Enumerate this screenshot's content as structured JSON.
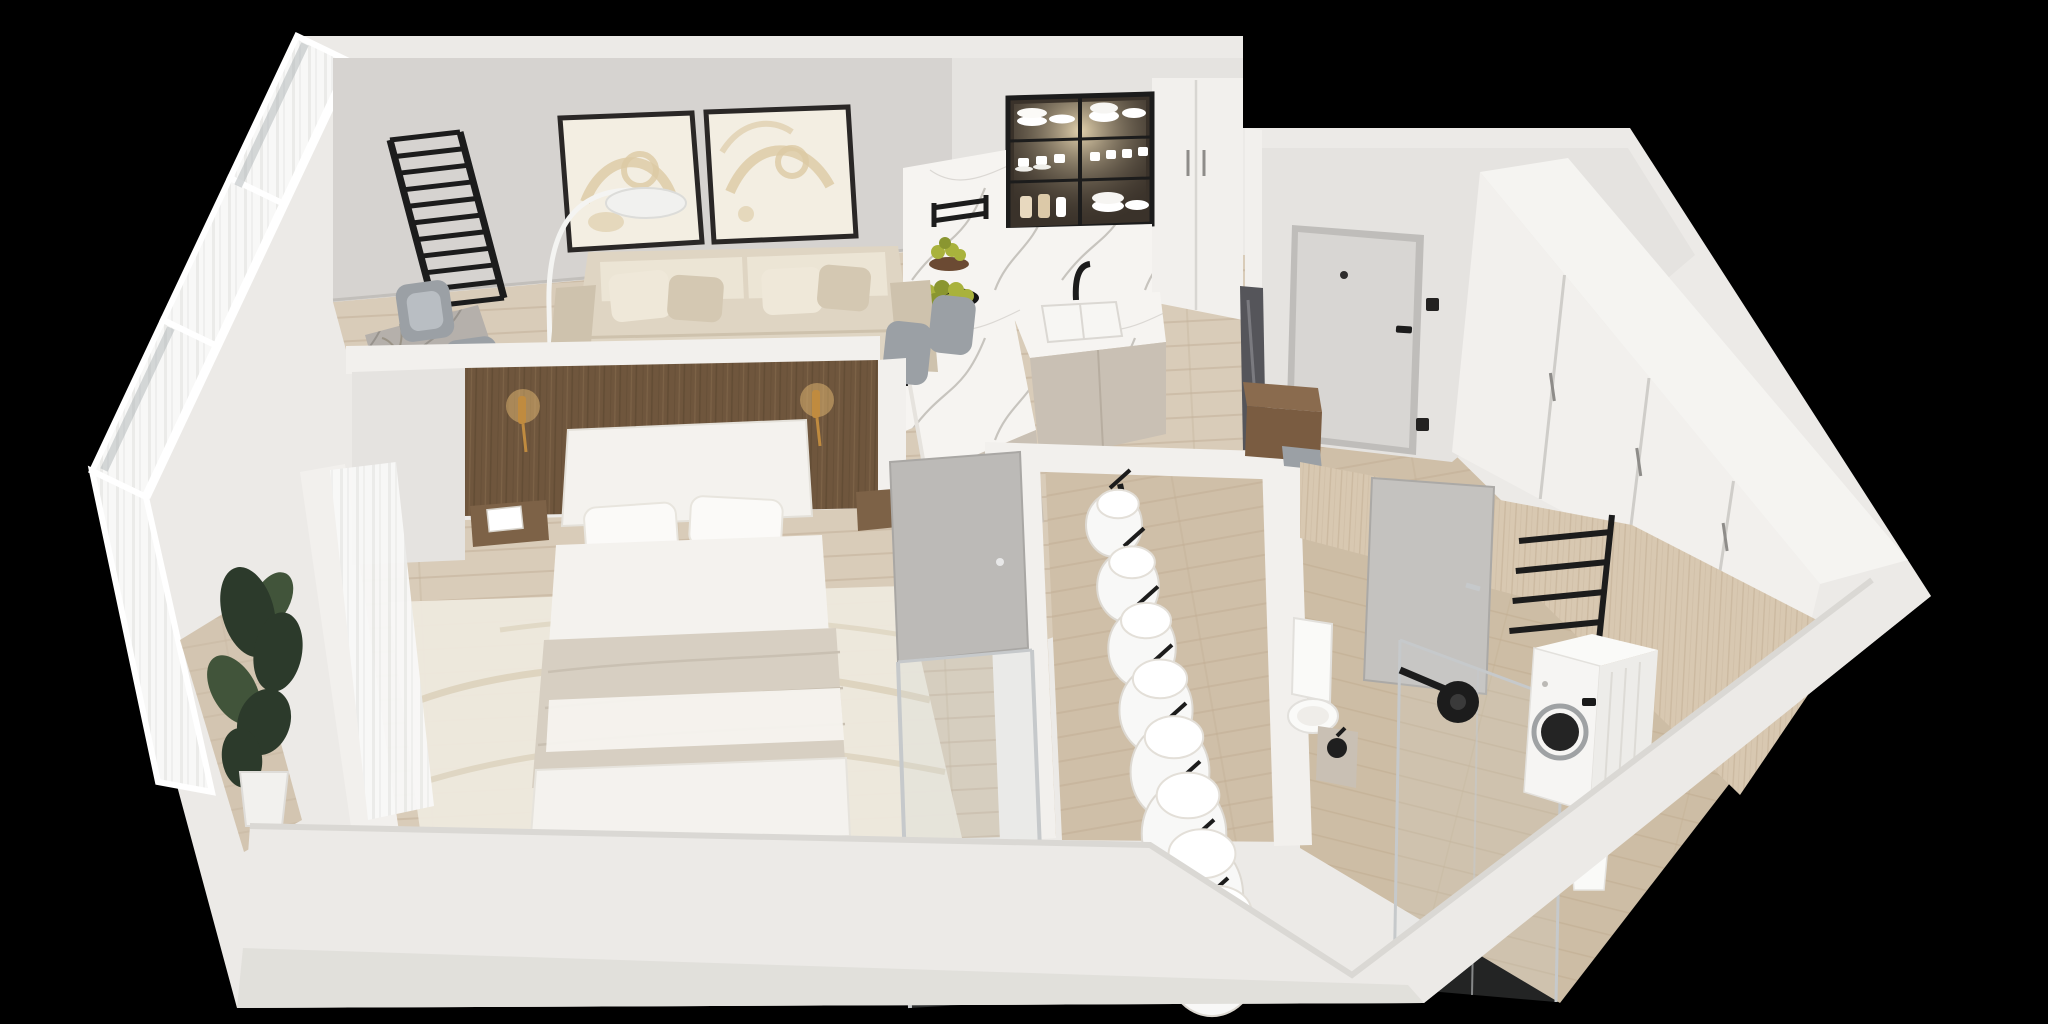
{
  "meta": {
    "scene": "3d-apartment-floor-plan-cutaway-render",
    "view": "isometric top-down, roofless, black background",
    "visible_text": "none"
  },
  "palette": {
    "bg": "#000000",
    "shell": "#ECEAE7",
    "shellShade": "#DAD8D4",
    "shellDark": "#C8C6C2",
    "wallGray": "#D6D3D0",
    "wallLight": "#F2F0ED",
    "wallMid": "#E5E3E0",
    "woodBase": "#D9CCB9",
    "woodLine": "#C3B19A",
    "woodEntry": "#CFBFA8",
    "walnutBase": "#6F563D",
    "walnutLine": "#58442E",
    "travBase": "#D8C8B1",
    "travLine": "#C2AE93",
    "travFloor": "#CDBDA5",
    "marbleBase": "#F6F4F1",
    "marbleVein": "#A9A49C",
    "marbleGray": "#B5B0AB",
    "marbleGrayVein": "#807B75",
    "sofaBase": "#DFD5C3",
    "sofaShade": "#CEC2AD",
    "pillowLight": "#EFE8D9",
    "pillowTaupe": "#D4C8B2",
    "bedWhite": "#F4F2EE",
    "blanket": "#D7CFC2",
    "rugBase": "#EDE8DD",
    "rugLine": "#D9CEB8",
    "curtain": "#F8F8F7",
    "curtainShade": "#EAEAE8",
    "glass": "#AFB5B7",
    "black": "#1C1C1C",
    "steel": "#C6C9CB",
    "brass": "#C08B3F",
    "brassGlow": "#F2C679",
    "plantDark": "#2C3A2B",
    "plantLight": "#41543A",
    "pear": "#A9B23C",
    "pearDark": "#8A9630",
    "doorGray": "#D8D6D3",
    "doorSlab": "#BCBAB7",
    "chairGray": "#9BA0A5",
    "chairLight": "#B9BEC3",
    "appliance": "#FAFAF8",
    "cabinetTaupe": "#C9C0B4",
    "cabinetInterior": "#3A322A",
    "artBeige": "#DCC9A4",
    "artCream": "#F3EEE2",
    "frameDark": "#2A2726"
  },
  "counts": {
    "ladder_rungs": 11,
    "garments": 8,
    "towel_bars": 4,
    "wardrobe_doors": 4,
    "artwork_panels": 2,
    "sofa_pillows": 4,
    "bed_pillows": 4
  },
  "rooms": [
    {
      "id": "balcony",
      "label": "Balcony",
      "features": [
        "glazed-window-wall",
        "sheer-curtains",
        "potted-plant",
        "wood-floor-strip"
      ]
    },
    {
      "id": "living-room",
      "label": "Living Room",
      "features": [
        "beige-sofa",
        "throw-pillows",
        "wall-art-diptych",
        "arc-floor-lamp",
        "swedish-wall-ladder",
        "marble-dining-table",
        "black-serving-tray",
        "gray-chairs",
        "wood-floor"
      ]
    },
    {
      "id": "kitchen",
      "label": "Kitchen",
      "features": [
        "glass-front-upper-cabinet",
        "dishware",
        "marble-backsplash",
        "black-rail",
        "white-sink",
        "black-faucet",
        "taupe-base-cabinets",
        "marble-peninsula",
        "pears-on-black-plate",
        "pear-pedestal-bowl",
        "tall-white-cabinet-column",
        "bar-stools"
      ]
    },
    {
      "id": "entry-hall",
      "label": "Entry Hall",
      "features": [
        "front-door",
        "door-handle",
        "peephole",
        "light-switches",
        "floor-mirror",
        "wood-bench",
        "seat-cushion",
        "white-wardrobe-run"
      ]
    },
    {
      "id": "bedroom",
      "label": "Bedroom",
      "features": [
        "walnut-headboard-wall",
        "brass-sconces",
        "floating-nightstands",
        "magazine",
        "double-bed",
        "taupe-blanket",
        "cream-area-rug",
        "sheer-curtain",
        "gray-closet-door"
      ]
    },
    {
      "id": "walk-in-closet",
      "label": "Walk-in Closet",
      "features": [
        "black-clothes-rail",
        "white-garments",
        "black-hangers",
        "glass-partition"
      ]
    },
    {
      "id": "bathroom",
      "label": "Bathroom",
      "features": [
        "travertine-walls",
        "travertine-floor",
        "gray-door",
        "black-towel-rack",
        "glass-shower-enclosure",
        "black-rain-shower-head",
        "toilet",
        "vanity-with-black-basin",
        "washing-machine",
        "waste-bin"
      ]
    }
  ]
}
